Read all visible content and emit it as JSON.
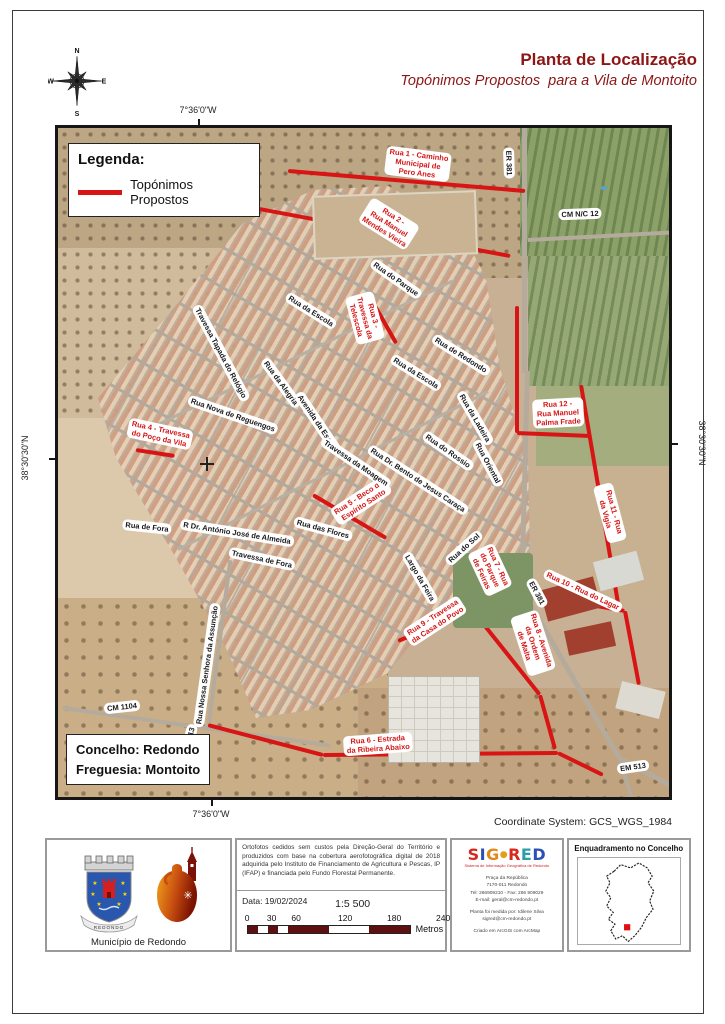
{
  "header": {
    "title": "Planta de Localização",
    "subtitle": "Topónimos Propostos  para a Vila de Montoito",
    "compass": {
      "n": "N",
      "e": "E",
      "s": "S",
      "w": "W"
    }
  },
  "map": {
    "legend": {
      "title": "Legenda:",
      "item": "Topónimos Propostos"
    },
    "info_box": {
      "line1": "Concelho: Redondo",
      "line2": "Freguesia: Montoito"
    },
    "coordinates": {
      "top": "7°36'0\"W",
      "bottom": "7°36'0\"W",
      "left": "38°30'30\"N",
      "right": "38°30'30\"N"
    },
    "labels": [
      {
        "t": "Rua 1 - Caminho\nMunicipal de\nPero Anes",
        "x": 360,
        "y": 36,
        "r": 7,
        "c": "r"
      },
      {
        "t": "Rua 2 -\nRua Manuel\nMendes Vieira",
        "x": 331,
        "y": 96,
        "r": 32,
        "c": "r"
      },
      {
        "t": "Rua 3 -\nTravessa da\nTelescola",
        "x": 307,
        "y": 190,
        "r": 75,
        "c": "r"
      },
      {
        "t": "Rua 4 - Travessa\ndo Poço da Vila",
        "x": 102,
        "y": 306,
        "r": 12,
        "c": "r"
      },
      {
        "t": "Rua 5 - Beco do\nEspírito Santo",
        "x": 303,
        "y": 373,
        "r": -33,
        "c": "r"
      },
      {
        "t": "Rua 6 - Estrada\nda Ribeira Abaixo",
        "x": 320,
        "y": 616,
        "r": -4,
        "c": "r"
      },
      {
        "t": "Rua 7 - Rua\ndo Parque\nde Feiras",
        "x": 432,
        "y": 442,
        "r": 65,
        "c": "r"
      },
      {
        "t": "Rua 8 - Avenida\nda Ordem\nde Malta",
        "x": 475,
        "y": 515,
        "r": 72,
        "c": "r"
      },
      {
        "t": "Rua 9 - Travessa\nda Casa do Povo",
        "x": 377,
        "y": 493,
        "r": -33,
        "c": "r"
      },
      {
        "t": "Rua 10 - Rua do Lagar",
        "x": 525,
        "y": 463,
        "r": 25,
        "c": "r"
      },
      {
        "t": "Rua 11 - Rua da Vigia",
        "x": 552,
        "y": 385,
        "r": 75,
        "c": "r"
      },
      {
        "t": "Rua 12 -\nRua Manuel\nPalma Frade",
        "x": 500,
        "y": 285,
        "r": -3,
        "c": "r"
      },
      {
        "t": "ER 381",
        "x": 451,
        "y": 35,
        "r": 88,
        "c": "k"
      },
      {
        "t": "CM N/C 12",
        "x": 522,
        "y": 86,
        "r": -2,
        "c": "k"
      },
      {
        "t": "Rua do Parque",
        "x": 338,
        "y": 151,
        "r": 35,
        "c": "k"
      },
      {
        "t": "Rua da Escola",
        "x": 253,
        "y": 183,
        "r": 32,
        "c": "k"
      },
      {
        "t": "Travessa Tapada do Relógio",
        "x": 163,
        "y": 225,
        "r": 62,
        "c": "k"
      },
      {
        "t": "Rua da Alegria",
        "x": 223,
        "y": 255,
        "r": 54,
        "c": "k"
      },
      {
        "t": "Avenida da Escola",
        "x": 260,
        "y": 295,
        "r": 56,
        "c": "k"
      },
      {
        "t": "Rua da Escola",
        "x": 358,
        "y": 245,
        "r": 32,
        "c": "k"
      },
      {
        "t": "Rua de Redondo",
        "x": 403,
        "y": 227,
        "r": 32,
        "c": "k"
      },
      {
        "t": "Rua da Ladeira",
        "x": 417,
        "y": 290,
        "r": 60,
        "c": "k"
      },
      {
        "t": "Rua Nova de Reguengos",
        "x": 175,
        "y": 287,
        "r": 19,
        "c": "k"
      },
      {
        "t": "Travessa da Moagem",
        "x": 298,
        "y": 335,
        "r": 34,
        "c": "k"
      },
      {
        "t": "Rua Dr. Bento de Jesus Caraça",
        "x": 360,
        "y": 352,
        "r": 33,
        "c": "k"
      },
      {
        "t": "Rua do Rossio",
        "x": 390,
        "y": 323,
        "r": 35,
        "c": "k"
      },
      {
        "t": "Rua Oriental",
        "x": 430,
        "y": 335,
        "r": 62,
        "c": "k"
      },
      {
        "t": "Rua de Fora",
        "x": 89,
        "y": 399,
        "r": 6,
        "c": "k"
      },
      {
        "t": "R Dr. António José de Almeida",
        "x": 179,
        "y": 405,
        "r": 9,
        "c": "k"
      },
      {
        "t": "Rua das Flores",
        "x": 265,
        "y": 401,
        "r": 15,
        "c": "k"
      },
      {
        "t": "Travessa de Fora",
        "x": 204,
        "y": 431,
        "r": 12,
        "c": "k"
      },
      {
        "t": "Rua do Sol",
        "x": 406,
        "y": 420,
        "r": -42,
        "c": "k"
      },
      {
        "t": "Largo da Feira",
        "x": 362,
        "y": 450,
        "r": 60,
        "c": "k"
      },
      {
        "t": "ER 381",
        "x": 479,
        "y": 465,
        "r": 62,
        "c": "k"
      },
      {
        "t": "Rua Nossa Senhora da Assunção",
        "x": 149,
        "y": 537,
        "r": -82,
        "c": "k"
      },
      {
        "t": "CM 1104",
        "x": 64,
        "y": 579,
        "r": -6,
        "c": "k"
      },
      {
        "t": "EM 513",
        "x": 131,
        "y": 612,
        "r": -75,
        "c": "k"
      },
      {
        "t": "EM 513",
        "x": 575,
        "y": 639,
        "r": -8,
        "c": "k"
      }
    ],
    "red_lines": [
      [
        230,
        43,
        467,
        63
      ],
      [
        180,
        77,
        452,
        128
      ],
      [
        317,
        178,
        338,
        215
      ],
      [
        78,
        322,
        117,
        328
      ],
      [
        255,
        367,
        328,
        410
      ],
      [
        459,
        178,
        459,
        305
      ],
      [
        459,
        305,
        532,
        308
      ],
      [
        523,
        257,
        560,
        475
      ],
      [
        470,
        435,
        476,
        467
      ],
      [
        476,
        467,
        567,
        483
      ],
      [
        567,
        483,
        581,
        557
      ],
      [
        397,
        431,
        415,
        483
      ],
      [
        340,
        513,
        415,
        483
      ],
      [
        415,
        483,
        482,
        567
      ],
      [
        482,
        567,
        497,
        621
      ],
      [
        150,
        597,
        265,
        627
      ],
      [
        265,
        627,
        500,
        625
      ],
      [
        500,
        625,
        545,
        647
      ]
    ]
  },
  "footer": {
    "coordinate_system": "Coordinate System: GCS_WGS_1984",
    "municipality": "Município de Redondo",
    "coat_ribbon": "REDONDO",
    "credits": "Ortofotos cedidos sem custos pela Direção-Geral do Território e produzidos com base na cobertura aerofotográfica digital de 2018 adquirida pelo Instituto de Financiamento de Agricultura e Pescas, IP (IFAP) e financiada pelo Fundo Florestal Permanente.",
    "date_label": "Data: 19/02/2024",
    "scale_text": "1:5 500",
    "scale_ticks": [
      "0",
      "30",
      "60",
      "120",
      "180",
      "240"
    ],
    "scale_unit": "Metros",
    "sigred": {
      "letters": [
        "S",
        "I",
        "G",
        "●",
        "R",
        "E",
        "D"
      ],
      "tagline": "Sistema de Informação Geográfica de Redondo",
      "address": [
        "Praça da República",
        "7170-011 Redondo",
        "Tel: 266909210 - Fax: 266 909029",
        "E-mail: geral@cm-redondo.pt",
        "",
        "Planta foi medida por: Idilene Silva",
        "sigred@cm-redondo.pt",
        "",
        "Criado em ArcGIS com ArcMap"
      ]
    },
    "enquadramento_title": "Enquadramento no Concelho"
  }
}
